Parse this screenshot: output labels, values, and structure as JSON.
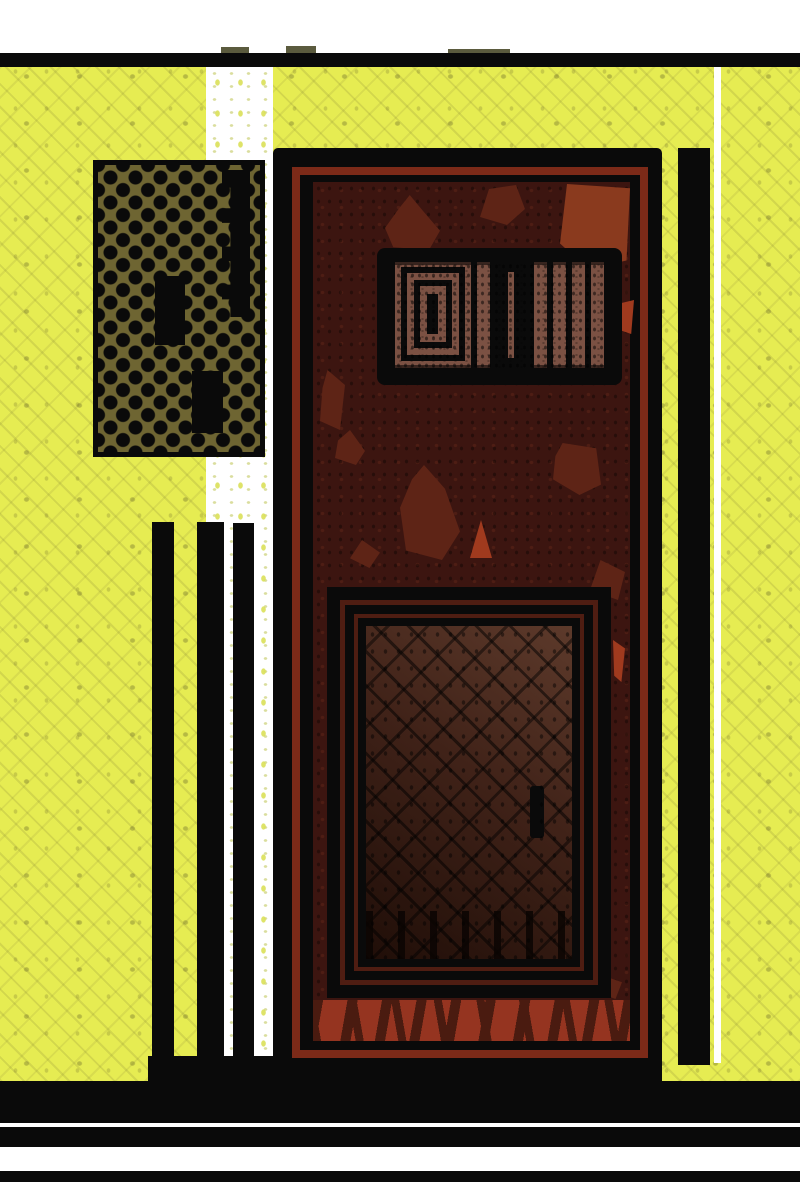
{
  "scene": {
    "description": "Stylized comic-style illustration of a dark red prison-like door set into a chartreuse textured wall, with a black halftone-dot panel on the left, black vertical stripes, a barred vent window in the upper door, a framed dark window panel with handle in the lower door, and bold black-and-white horizontal bands at top and bottom.",
    "style": "flat ink and halftone comic art",
    "text_content": "none"
  },
  "elements": [
    {
      "name": "top-bar",
      "kind": "horizontal black band"
    },
    {
      "name": "wall",
      "kind": "chartreuse wall with crosshatch texture"
    },
    {
      "name": "white-band",
      "kind": "white vertical stripe behind left objects"
    },
    {
      "name": "halftone-panel",
      "kind": "olive panel with black halftone dots and black bars"
    },
    {
      "name": "left-stripes",
      "kind": "three black vertical stripes",
      "count": 3
    },
    {
      "name": "door",
      "kind": "dark maroon door with red trim"
    },
    {
      "name": "vent-grate",
      "kind": "black barred vent window in upper door"
    },
    {
      "name": "lower-window-panel",
      "kind": "nested black frames around dark crosshatched window with handle"
    },
    {
      "name": "kickplate",
      "kind": "red streaked band at door bottom"
    },
    {
      "name": "right-stripe",
      "kind": "black vertical stripe right of door"
    },
    {
      "name": "floor-bands",
      "kind": "alternating black and white horizontal bands",
      "count": 3
    }
  ],
  "palette": {
    "paper": "#ffffff",
    "ink": "#0a0a0a",
    "yellow": "#e6ec52",
    "olive_mark": "#8f9148",
    "halftone_bg": "#6e6532",
    "door_red": "#7c2a18",
    "maroon": "#3c1510",
    "blotch_mid": "#5e2416",
    "blotch_bright": "#8a3a1e",
    "accent_red": "#a03a1e",
    "grate_fill": "#7b5143",
    "panel_light": "#5d3a2b",
    "panel_dark": "#200e08",
    "gap_red": "#4f1d12",
    "band_red": "#953420",
    "band_streak": "#4a1b10"
  }
}
